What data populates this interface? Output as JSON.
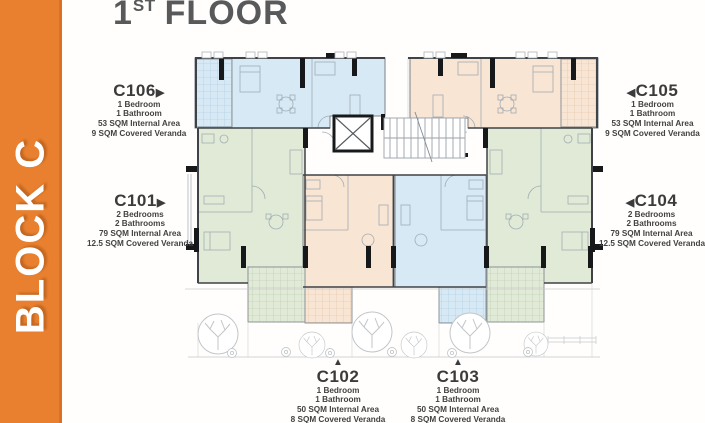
{
  "header": {
    "floor_number": "1",
    "floor_suffix": "ST",
    "floor_word": "FLOOR",
    "text_color": "#58595B"
  },
  "sidebar": {
    "label": "BLOCK C",
    "background": "#E8802F",
    "edge_color": "#DB7124",
    "text_color": "#FFFFFF"
  },
  "apartments": [
    {
      "id": "C106",
      "arrow": "right",
      "arrow_glyph": "▶",
      "region_color": "#D7E9F4",
      "lines": [
        "1 Bedroom",
        "1 Bathroom",
        "53 SQM Internal Area",
        "9 SQM Covered Veranda"
      ]
    },
    {
      "id": "C101",
      "arrow": "right",
      "arrow_glyph": "▶",
      "region_color": "#E1EAD7",
      "lines": [
        "2 Bedrooms",
        "2 Bathrooms",
        "79 SQM Internal Area",
        "12.5 SQM Covered Veranda"
      ]
    },
    {
      "id": "C105",
      "arrow": "left",
      "arrow_glyph": "◀",
      "region_color": "#F8E5D3",
      "lines": [
        "1 Bedroom",
        "1 Bathroom",
        "53 SQM Internal Area",
        "9 SQM Covered Veranda"
      ]
    },
    {
      "id": "C104",
      "arrow": "left",
      "arrow_glyph": "◀",
      "region_color": "#E1EAD7",
      "lines": [
        "2 Bedrooms",
        "2 Bathrooms",
        "79 SQM Internal Area",
        "12.5 SQM Covered Veranda"
      ]
    },
    {
      "id": "C102",
      "arrow": "up",
      "arrow_glyph": "▲",
      "region_color": "#F8E5D3",
      "lines": [
        "1 Bedroom",
        "1 Bathroom",
        "50 SQM Internal Area",
        "8 SQM Covered Veranda"
      ]
    },
    {
      "id": "C103",
      "arrow": "up",
      "arrow_glyph": "▲",
      "region_color": "#D7E9F4",
      "lines": [
        "1 Bedroom",
        "1 Bathroom",
        "50 SQM Internal Area",
        "8 SQM Covered Veranda"
      ]
    }
  ],
  "plan": {
    "colors": {
      "blue": "#D7E9F4",
      "green": "#E1EAD7",
      "peach": "#F8E5D3",
      "wall": "#3F4347",
      "black": "#16181A"
    }
  }
}
